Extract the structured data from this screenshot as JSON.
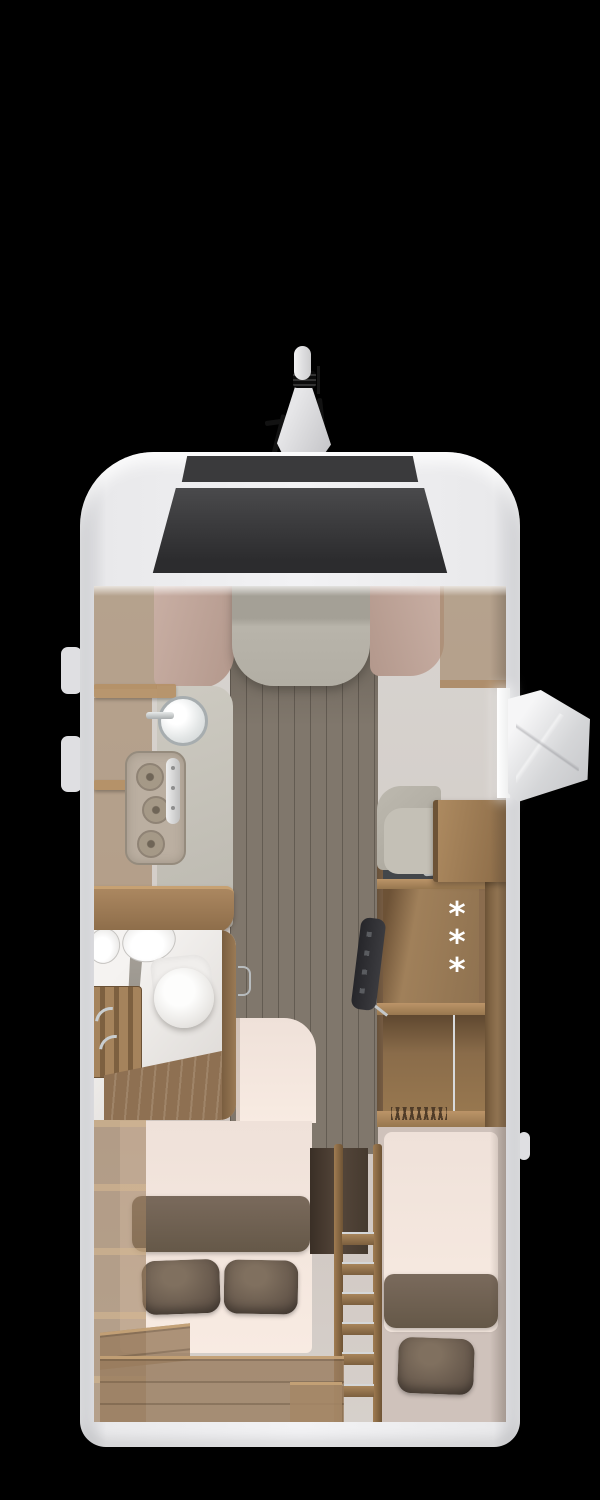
{
  "scene": {
    "type": "motorhome floor plan, top-down 3D render",
    "background_color": "#000000"
  },
  "vehicle": {
    "body_color": "#ebebed",
    "roof_panel_color": "#3a3a3c",
    "windshield_color": "#353537",
    "antenna": {
      "name": "roof-satellite-antenna",
      "color": "#d8d8da"
    },
    "entry_door": {
      "state": "open",
      "side": "right",
      "color": "#e9e9eb"
    }
  },
  "interior": {
    "cab": {
      "left_seat_color": "#c0a69b",
      "right_seat_color": "#c0a69b",
      "center_cushion_color": "#b0aca2"
    },
    "kitchen": {
      "counter_color": "#c6c3ba",
      "burner_count": 3,
      "sink_count": 1
    },
    "bathroom": {
      "wall_color": "#efedeb",
      "fixtures": [
        "toilet",
        "washbasin",
        "washbasin",
        "shower-bench"
      ]
    },
    "fridge": {
      "symbols": [
        "*",
        "*",
        "*"
      ],
      "symbol_color": "#ffffff",
      "cabinet_color": "#8a6c4e"
    },
    "dinette": {
      "cushion_color": "#b6b2a8",
      "table_color": "#9c7c56"
    },
    "tv": {
      "color": "#2e2e30"
    },
    "beds": {
      "left_bed": {
        "mattress_color": "#f7eae1",
        "blanket_color": "#6e6153",
        "pillow_count": 2
      },
      "right_bed": {
        "mattress_color": "#f7eae1",
        "blanket_color": "#6e6153",
        "pillow_count": 1
      },
      "pillow_color": "#64564a"
    },
    "ladder": {
      "steps": 6,
      "color": "#8a6c4e"
    },
    "floor_plank_color": "#80776c",
    "wall_color": "#cdc5bf"
  }
}
